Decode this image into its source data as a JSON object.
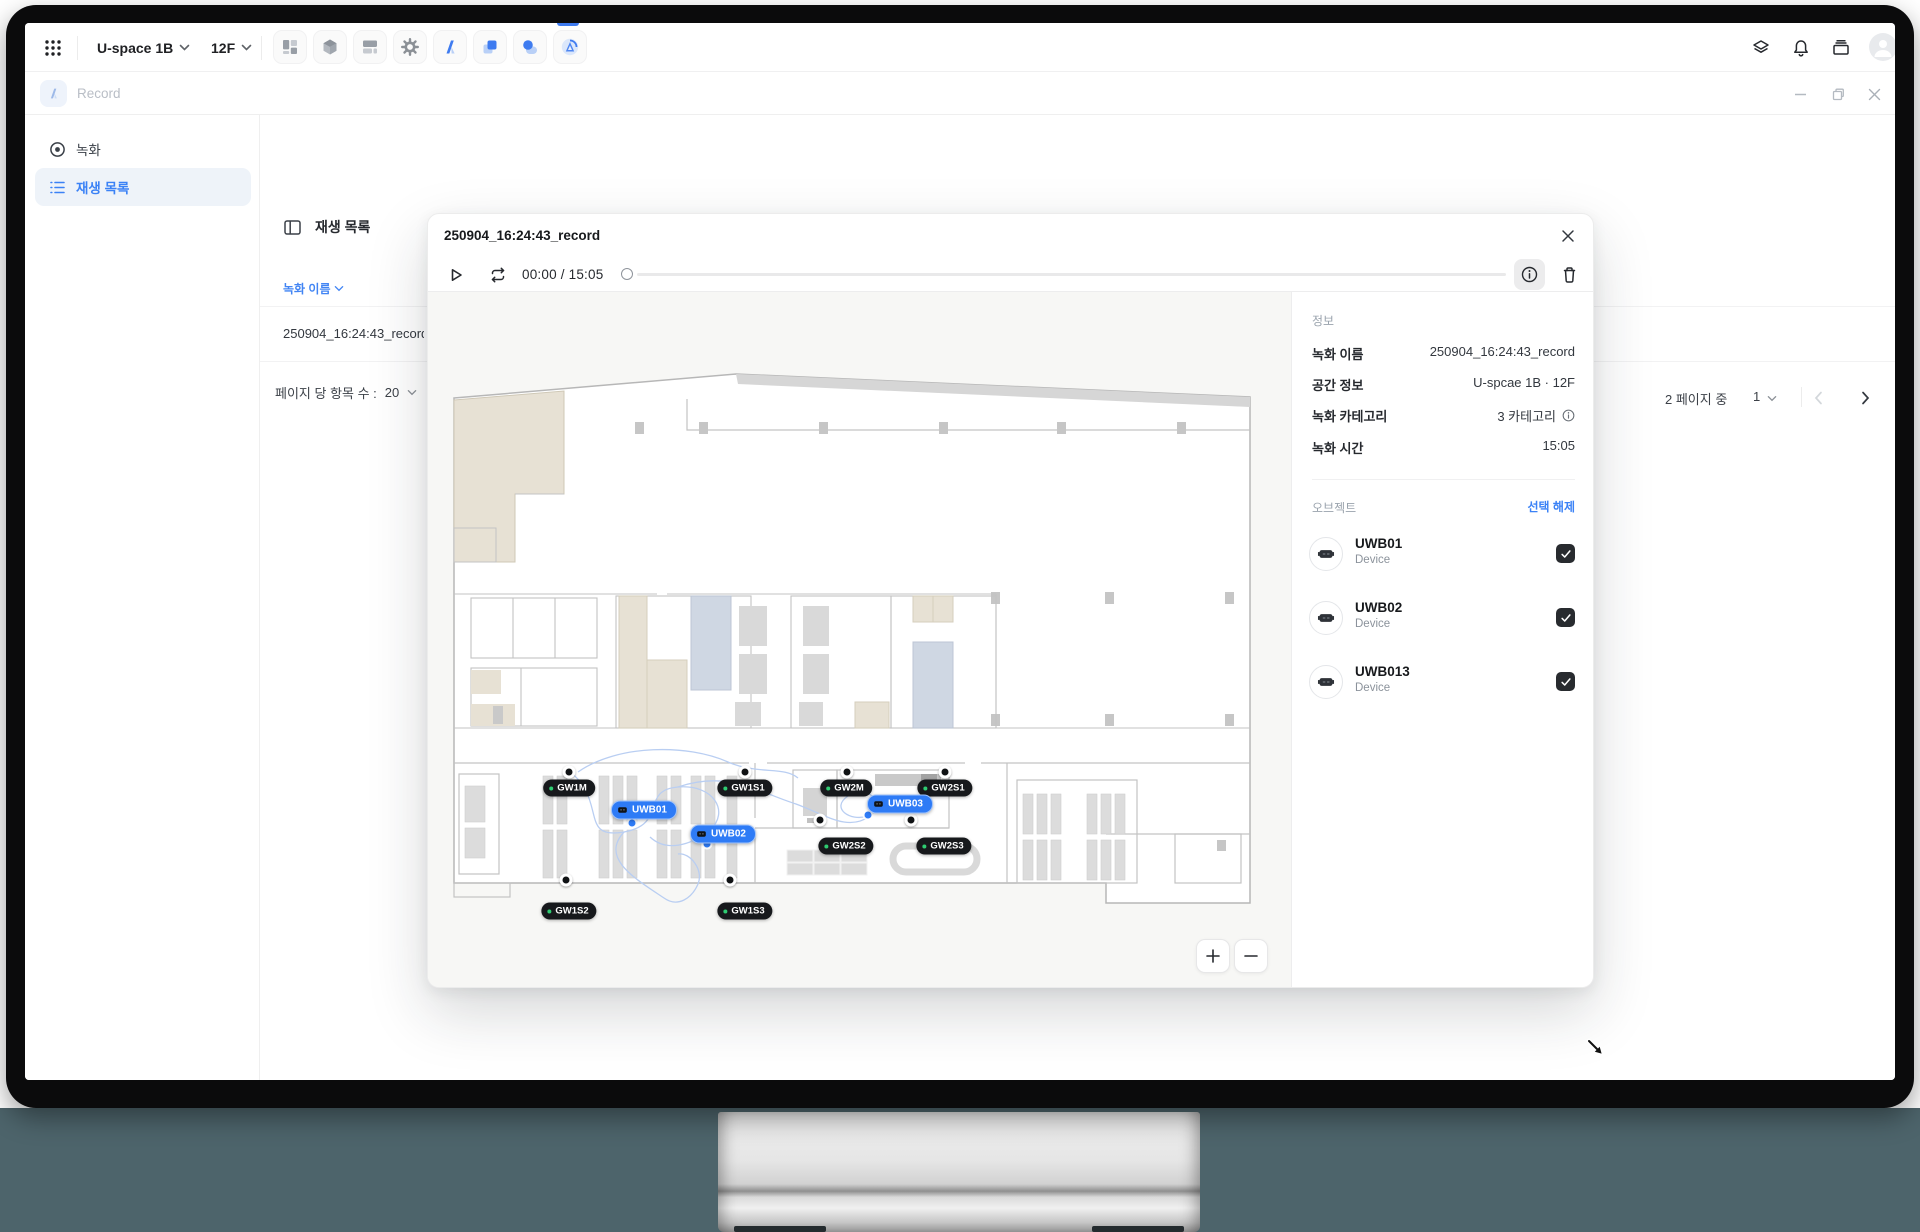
{
  "accent": "#3b82f6",
  "topbar": {
    "space": "U-space 1B",
    "floor": "12F"
  },
  "titlebar": {
    "app_title": "Record"
  },
  "sidebar": {
    "items": [
      {
        "label": "녹화"
      },
      {
        "label": "재생 목록"
      }
    ]
  },
  "main": {
    "title": "재생 목록",
    "columns": [
      "녹화 이름",
      "녹화 길이",
      "녹화 시작 시간",
      "녹화 종료 시간",
      "카테고리",
      "위치"
    ],
    "rows": [
      {
        "name": "250904_16:24:43_record"
      }
    ],
    "items_per_page_label": "페이지 당 항목 수 :",
    "items_per_page": "20",
    "pagination": {
      "total_label": "2 페이지 중",
      "current_page": "1"
    }
  },
  "modal": {
    "title": "250904_16:24:43_record",
    "player": {
      "time": "00:00 / 15:05"
    },
    "info": {
      "section": "정보",
      "rows": [
        {
          "label": "녹화 이름",
          "value": "250904_16:24:43_record",
          "info_icon": false
        },
        {
          "label": "공간 정보",
          "value": "U-spcae 1B · 12F",
          "info_icon": false
        },
        {
          "label": "녹화 카테고리",
          "value": "3 카테고리",
          "info_icon": true
        },
        {
          "label": "녹화 시간",
          "value": "15:05",
          "info_icon": false
        }
      ]
    },
    "objects": {
      "section": "오브젝트",
      "clear_label": "선택 해제",
      "devices": [
        {
          "name": "UWB01",
          "type": "Device",
          "checked": true
        },
        {
          "name": "UWB02",
          "type": "Device",
          "checked": true
        },
        {
          "name": "UWB013",
          "type": "Device",
          "checked": true
        }
      ]
    },
    "map": {
      "gateways": [
        {
          "label": "GW1M",
          "x": 141,
          "y": 496
        },
        {
          "label": "GW1S1",
          "x": 317,
          "y": 496
        },
        {
          "label": "GW2M",
          "x": 418,
          "y": 496
        },
        {
          "label": "GW2S1",
          "x": 517,
          "y": 496
        },
        {
          "label": "GW2S2",
          "x": 418,
          "y": 554
        },
        {
          "label": "GW2S3",
          "x": 516,
          "y": 554
        },
        {
          "label": "GW1S2",
          "x": 141,
          "y": 619
        },
        {
          "label": "GW1S3",
          "x": 317,
          "y": 619
        }
      ],
      "tags": [
        {
          "label": "UWB01",
          "x": 216,
          "y": 518
        },
        {
          "label": "UWB02",
          "x": 295,
          "y": 542
        },
        {
          "label": "UWB03",
          "x": 472,
          "y": 512
        }
      ],
      "anchors": [
        [
          141,
          480
        ],
        [
          317,
          480
        ],
        [
          419,
          480
        ],
        [
          517,
          480
        ],
        [
          392,
          528
        ],
        [
          483,
          528
        ],
        [
          138,
          588
        ],
        [
          302,
          588
        ]
      ],
      "tag_dots": [
        [
          204,
          531
        ],
        [
          279,
          552
        ],
        [
          440,
          523
        ]
      ]
    }
  }
}
